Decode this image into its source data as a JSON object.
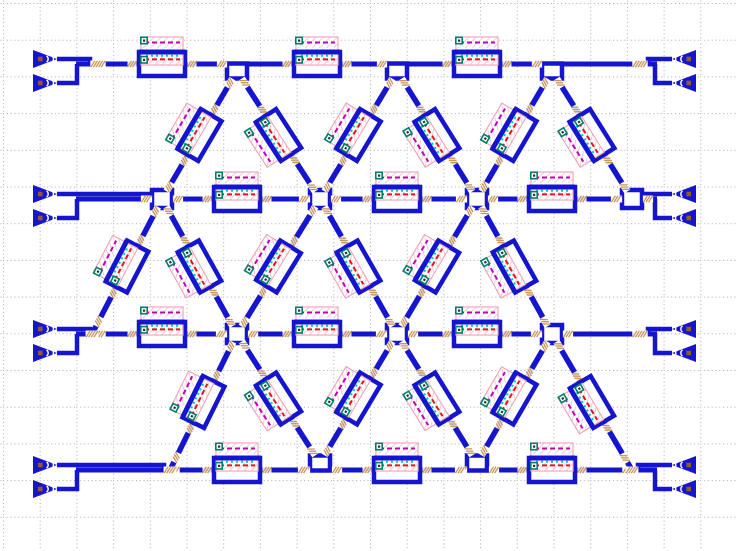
{
  "app": {
    "name": "photonic-mesh-layout-canvas"
  },
  "canvas": {
    "w": 737,
    "h": 551,
    "bg": "#ffffff"
  },
  "grid": {
    "spacing": 36.7,
    "offset": 3,
    "color": "#a9a9a9",
    "dash": "1 2.8"
  },
  "colors": {
    "waveguide": "#1515cf",
    "loop_fill": "#ffffff",
    "heater_border": "#efa3b7",
    "heater_hatch": "#f3bcca",
    "heater_fill": "#ffffff",
    "magenta_dash": "#bf00bf",
    "red_dash": "#e01414",
    "cyan_dash": "#00c6c6",
    "pad_border": "#007d6b",
    "pad_fill": "#ffffff",
    "pad_dot": "#223333",
    "transition": "#c89358",
    "coupler_marker": "#99552b",
    "coupler_detail": "#ffffff"
  },
  "geometry": {
    "bus_rows": [
      {
        "y": 64,
        "x1": 76,
        "x2": 657
      },
      {
        "y": 199,
        "x1": 76,
        "x2": 657
      },
      {
        "y": 334,
        "x1": 76,
        "x2": 657
      },
      {
        "y": 470,
        "x1": 76,
        "x2": 657
      }
    ],
    "coupler": {
      "tip_left": 57,
      "tip_right": 672,
      "len": 24,
      "half_h": 9,
      "dy_top": -5,
      "dy_bottom": 19,
      "riser_left": 77,
      "riser_right": 655,
      "merge_left": [
        90,
        156,
        90,
        164
      ],
      "merge_right": [
        648,
        640,
        648,
        638
      ]
    },
    "mzi_horizontal": [
      {
        "x": 162,
        "y": 64
      },
      {
        "x": 317,
        "y": 64
      },
      {
        "x": 477,
        "y": 64
      },
      {
        "x": 237,
        "y": 199
      },
      {
        "x": 397,
        "y": 199
      },
      {
        "x": 552,
        "y": 199
      },
      {
        "x": 162,
        "y": 334
      },
      {
        "x": 317,
        "y": 334
      },
      {
        "x": 477,
        "y": 334
      },
      {
        "x": 237,
        "y": 470
      },
      {
        "x": 397,
        "y": 470
      },
      {
        "x": 552,
        "y": 470
      }
    ],
    "nodes": [
      {
        "x": 237,
        "y": 71,
        "type": "below"
      },
      {
        "x": 397,
        "y": 71,
        "type": "below"
      },
      {
        "x": 552,
        "y": 71,
        "type": "below"
      },
      {
        "x": 162,
        "y": 199,
        "type": "center"
      },
      {
        "x": 320,
        "y": 199,
        "type": "center"
      },
      {
        "x": 477,
        "y": 199,
        "type": "center"
      },
      {
        "x": 632,
        "y": 199,
        "type": "center"
      },
      {
        "x": 237,
        "y": 334,
        "type": "center"
      },
      {
        "x": 397,
        "y": 334,
        "type": "center"
      },
      {
        "x": 552,
        "y": 334,
        "type": "center"
      },
      {
        "x": 320,
        "y": 463,
        "type": "above"
      },
      {
        "x": 477,
        "y": 463,
        "type": "above"
      }
    ],
    "diagonals": [
      [
        237,
        71,
        162,
        199
      ],
      [
        237,
        71,
        320,
        199
      ],
      [
        397,
        71,
        320,
        199
      ],
      [
        397,
        71,
        477,
        199
      ],
      [
        552,
        71,
        477,
        199
      ],
      [
        552,
        71,
        632,
        199
      ],
      [
        162,
        199,
        92,
        334
      ],
      [
        162,
        199,
        237,
        334
      ],
      [
        320,
        199,
        237,
        334
      ],
      [
        320,
        199,
        397,
        334
      ],
      [
        477,
        199,
        397,
        334
      ],
      [
        477,
        199,
        552,
        334
      ],
      [
        237,
        334,
        170,
        470
      ],
      [
        237,
        334,
        320,
        463
      ],
      [
        397,
        334,
        320,
        463
      ],
      [
        397,
        334,
        477,
        463
      ],
      [
        552,
        334,
        477,
        463
      ],
      [
        552,
        334,
        632,
        470
      ]
    ],
    "cap_ticks": [
      [
        92,
        334
      ],
      [
        170,
        470
      ],
      [
        632,
        470
      ]
    ]
  }
}
